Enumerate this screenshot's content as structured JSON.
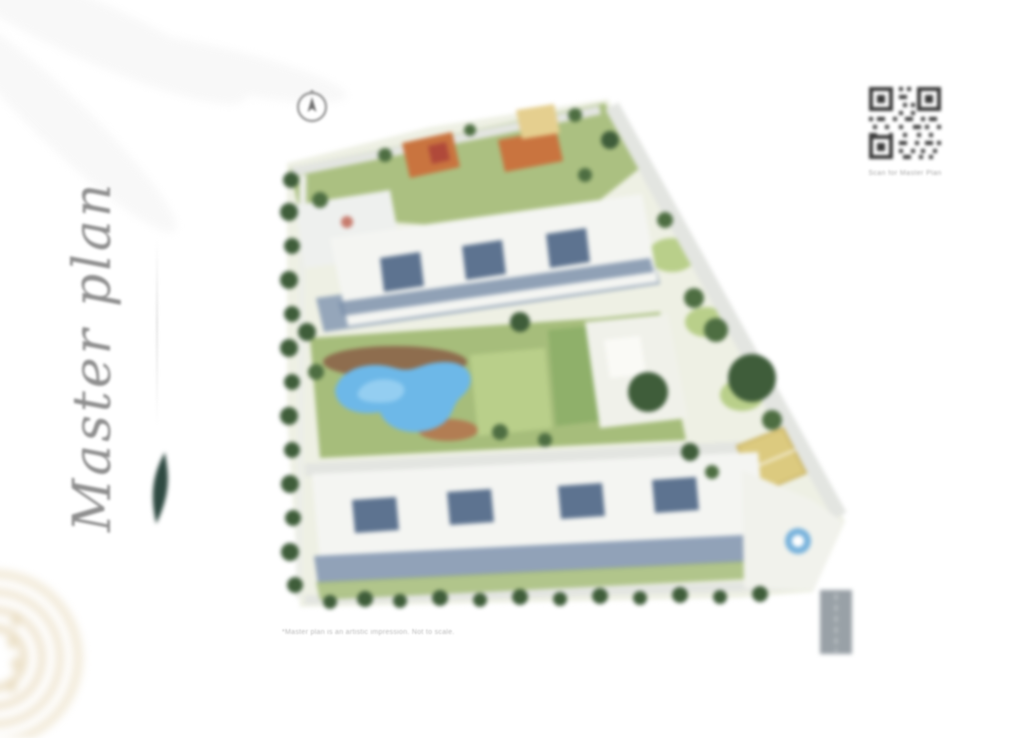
{
  "page": {
    "title": "Master plan",
    "footnote": "*Master plan is an artistic impression. Not to scale."
  },
  "qr": {
    "caption": "Scan for Master Plan"
  },
  "map": {
    "type": "residential-site-plan",
    "features": [
      "north-compass",
      "perimeter-trees",
      "entry-road",
      "clubhouse-plaza",
      "swimming-pool",
      "pool-deck",
      "central-lawn",
      "north-apartment-block",
      "south-apartment-blocks",
      "orange-roof-villas",
      "sports-court",
      "entrance-water-feature",
      "access-road-stub",
      "surface-parking"
    ]
  },
  "colors": {
    "title": "#8f8f8f",
    "leaf_accent": "#2f4a42",
    "site_base": "#eef0e4",
    "lawn": "#a6bd7b",
    "lawn_light": "#b9cf8a",
    "tree": "#3f5d3a",
    "tree_light": "#4e6e42",
    "road": "#e3e5e1",
    "building": "#f4f5f2",
    "building_glass": "#7e92ac",
    "building_shadow": "#8b9db5",
    "courtyard_dark": "#5d7390",
    "pool": "#6db8e8",
    "pool_light": "#9ed3f2",
    "deck_brown": "#8a5f46",
    "roof_orange": "#c9743f",
    "roof_yellow": "#e5cf8f",
    "roof_red": "#b0493a",
    "court": "#dcca7f",
    "road_stub": "#99a1a7",
    "arc_decoration": "#e9dcc0",
    "qr_ink": "#3a3a3a"
  }
}
